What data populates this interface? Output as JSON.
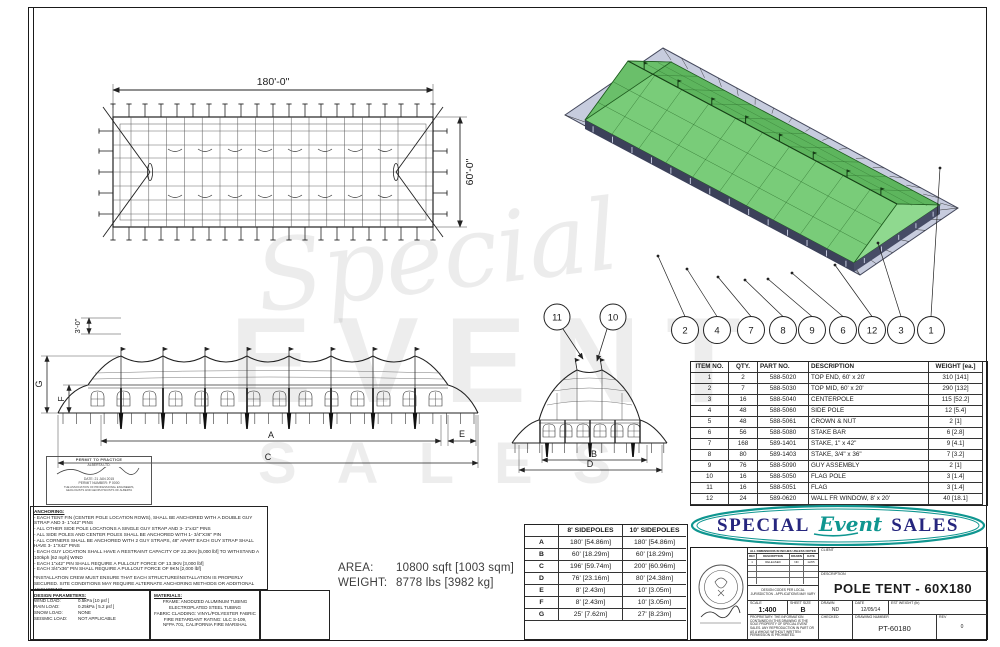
{
  "plan_view": {
    "width_label": "180'-0\"",
    "height_label": "60'-0\""
  },
  "side_view": {
    "dim_3ft": "3'-0\"",
    "dim_g": "G",
    "dim_f": "F",
    "dim_a": "A",
    "dim_e": "E",
    "dim_c": "C"
  },
  "end_view": {
    "dim_b": "B",
    "dim_d": "D",
    "callout_flag": "11",
    "callout_flagpole": "10"
  },
  "iso_view": {
    "callouts": [
      "2",
      "4",
      "7",
      "8",
      "9",
      "6",
      "12",
      "3",
      "1"
    ]
  },
  "watermark": {
    "line1": "Special",
    "line2": "EVENT",
    "line3": "SALES"
  },
  "parts_table": {
    "headers": [
      "ITEM NO.",
      "QTY.",
      "PART NO.",
      "DESCRIPTION",
      "WEIGHT [ea.]"
    ],
    "rows": [
      [
        "1",
        "2",
        "588-5020",
        "TOP END, 60' x 20'",
        "310 [141]"
      ],
      [
        "2",
        "7",
        "588-5030",
        "TOP MID, 60' x 20'",
        "290 [132]"
      ],
      [
        "3",
        "16",
        "588-5040",
        "CENTERPOLE",
        "115 [52.2]"
      ],
      [
        "4",
        "48",
        "588-5060",
        "SIDE POLE",
        "12 [5.4]"
      ],
      [
        "5",
        "48",
        "588-5061",
        "CROWN & NUT",
        "2 [1]"
      ],
      [
        "6",
        "56",
        "588-5080",
        "STAKE BAR",
        "6 [2.8]"
      ],
      [
        "7",
        "168",
        "589-1401",
        "STAKE, 1\" x 42\"",
        "9 [4.1]"
      ],
      [
        "8",
        "80",
        "589-1403",
        "STAKE, 3/4\" x 36\"",
        "7 [3.2]"
      ],
      [
        "9",
        "76",
        "588-5090",
        "GUY ASSEMBLY",
        "2 [1]"
      ],
      [
        "10",
        "16",
        "588-5050",
        "FLAG POLE",
        "3 [1.4]"
      ],
      [
        "11",
        "16",
        "588-5051",
        "FLAG",
        "3 [1.4]"
      ],
      [
        "12",
        "24",
        "589-0620",
        "WALL FR WINDOW, 8' x 20'",
        "40 [18.1]"
      ]
    ]
  },
  "sidepole_table": {
    "headers": [
      "",
      "8' SIDEPOLES",
      "10' SIDEPOLES"
    ],
    "rows": [
      [
        "A",
        "180' [54.86m]",
        "180' [54.86m]"
      ],
      [
        "B",
        "60' [18.29m]",
        "60' [18.29m]"
      ],
      [
        "C",
        "196' [59.74m]",
        "200' [60.96m]"
      ],
      [
        "D",
        "76' [23.16m]",
        "80' [24.38m]"
      ],
      [
        "E",
        "8' [2.43m]",
        "10' [3.05m]"
      ],
      [
        "F",
        "8' [2.43m]",
        "10' [3.05m]"
      ],
      [
        "G",
        "25' [7.62m]",
        "27' [8.23m]"
      ]
    ]
  },
  "area_weight": {
    "area_label": "AREA:",
    "area_value": "10800 sqft  [1003 sqm]",
    "weight_label": "WEIGHT:",
    "weight_value": "8778 lbs   [3982 kg]"
  },
  "logo": {
    "word1": "SPECIAL",
    "word2": "Event",
    "word3": "SALES",
    "navy": "#26267e",
    "teal": "#0f9690"
  },
  "anchoring": {
    "title": "ANCHORING:",
    "lines": [
      "- EACH TENT FIN (CENTER POLE LOCATION ROWS), SHALL BE ANCHORED WITH A DOUBLE GUY STRAP AND 3- 1\"x42\" PINS",
      "- ALL OTHER SIDE POLE LOCATIONS A SINGLE GUY STRAP AND 3- 1\"x42\" PINS",
      "- ALL SIDE POLES AND CENTER POLES SHALL BE ANCHORED WITH 1- 3/4\"X36\" PIN",
      "- ALL CORNERS SHALL BE ANCHORED WITH 2 GUY STRAPS, 48\" APART EACH GUY STRAP SHALL HAVE 3- 1\"X42\" PINS",
      "- EACH GUY LOCATION SHALL HAVE A RESTRAINT CAPACITY OF 22.2KN [5,000 lbf] TO WITHSTAND A 100kph [62 mph] WIND",
      "- EACH 1\"x42\" PIN SHALL REQUIRE A PULLOUT FORCE OF 13.3KN [3,000 lbf]",
      "- EACH 3/4\"x36\" PIN SHALL REQUIRE A PULLOUT FORCE OF 9KN [2,000 lbf]"
    ],
    "note": "*INSTALLATION CREW MUST ENSURE THAT EACH STRUCTURE/INSTALLATION IS PROPERLY SECURED.  SITE CONDITIONS MAY REQUIRE ALTERNATE ANCHORING METHODS OR ADDITIONAL ANCHORING."
  },
  "design_parameters": {
    "title": "DESIGN PARAMETERS:",
    "rows": [
      [
        "WIND LOAD:",
        "0.5kPa  [10 psf ]"
      ],
      [
        "RAIN LOAD:",
        "0.25kPa [ 5.2 psf ]"
      ],
      [
        "SNOW LOAD:",
        "NONE"
      ],
      [
        "SEISMIC LOAD:",
        "NOT APPLICABLE"
      ]
    ]
  },
  "materials": {
    "title": "MATERIALS:",
    "lines": [
      "FRAME: ANODIZED ALUMINUM TUBING",
      "ELECTROPLATED STEEL TUBING",
      "FABRIC CLADDING: VINYL/POLYESTER FABRIC",
      "FIRE RETARDANT RATING: ULC S-109,",
      "NFPA 701, CALIFORNIA FIRE MARSHAL"
    ]
  },
  "permit_stamp": {
    "title": "PERMIT TO PRACTICE",
    "subtitle": "ALBERTA LTD.",
    "date_line": "DATE:  21 JAN 2015",
    "permit_line": "PERMIT NUMBER:  P 0000",
    "assoc1": "THE ASSOCIATION OF PROFESSIONAL ENGINEERS,",
    "assoc2": "GEOLOGISTS AND GEOPHYSICISTS OF ALBERTA"
  },
  "title_block": {
    "rev_table": {
      "title": "ALL DIMENSIONS IN INCHES UNLESS NOTED",
      "headers": [
        "REV",
        "DESCRIPTION",
        "DRAWN",
        "DATE"
      ],
      "row1": [
        "1",
        "RELEASED",
        "ND",
        "12/05"
      ]
    },
    "note_lines": "DESIGN CODES PER LOCAL JURISDICTION - APPLICATIONS MAY VARY",
    "scale_label": "SCALE",
    "scale_value": "1:400",
    "sheet_label": "SHEET SIZE",
    "sheet_value": "B",
    "disclaimer": "PROPRIETARY: THE INFORMATION CONTAINED IN THIS DRAWING IS THE SOLE PROPERTY OF SPECIAL EVENT SALES. ANY REPRODUCTION IN PART OR AS A WHOLE WITHOUT WRITTEN PERMISSION IS PROHIBITED.",
    "client_label": "CLIENT",
    "description_label": "DESCRIPTION",
    "description_value": "POLE TENT - 60X180",
    "drawn_label": "DRAWN",
    "drawn_value": "ND",
    "date_label": "DATE",
    "date_value": "12/05/14",
    "est_weight_label": "EST WEIGHT (lb)",
    "checked_label": "CHECKED",
    "drawing_number_label": "DRAWING NUMBER",
    "drawing_number_value": "PT-60180",
    "rev_label": "REV",
    "rev_value": "0"
  }
}
